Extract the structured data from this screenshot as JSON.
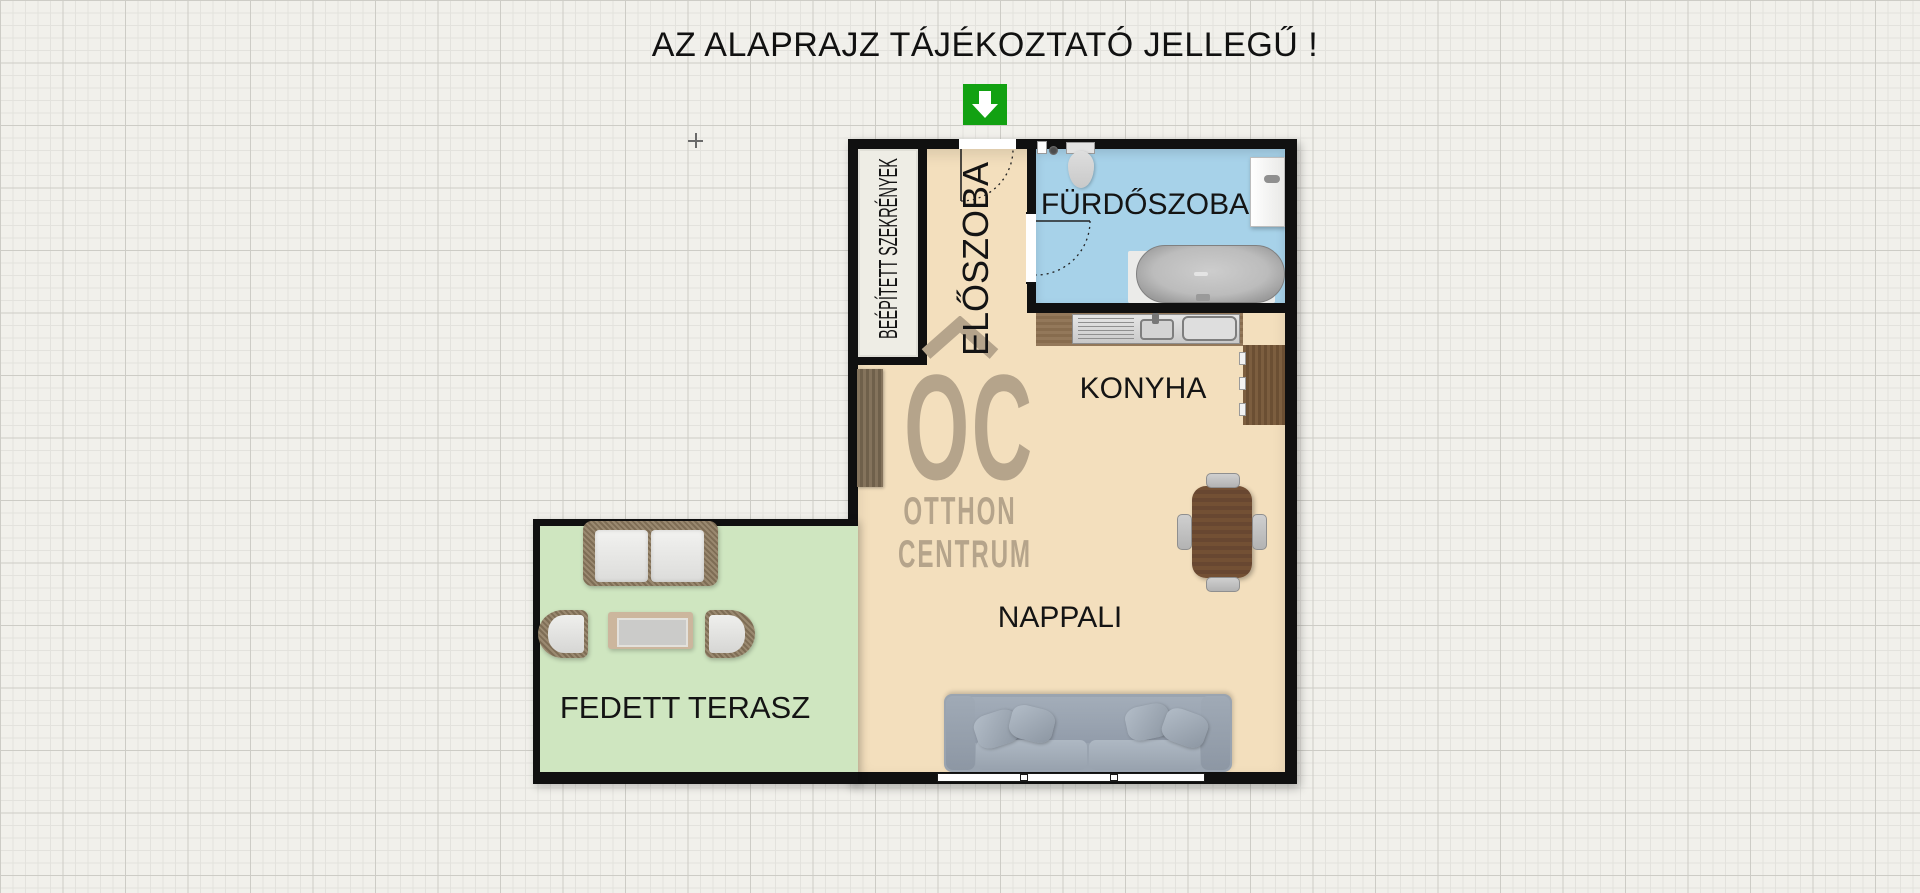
{
  "title": "AZ ALAPRAJZ TÁJÉKOZTATÓ JELLEGŰ !",
  "entrance": {
    "icon": "entrance-arrow-icon",
    "direction": "down",
    "color": "#12a112"
  },
  "rooms": {
    "hall": {
      "label": "ELŐSZOBA"
    },
    "closet": {
      "label": "BEÉPÍTETT SZEKRÉNYEK"
    },
    "bathroom": {
      "label": "FÜRDŐSZOBA"
    },
    "kitchen": {
      "label": "KONYHA"
    },
    "living": {
      "label": "NAPPALI"
    },
    "terrace": {
      "label": "FEDETT TERASZ"
    }
  },
  "watermark": {
    "roof_icon": "roof-chevron-icon",
    "initials": "OC",
    "line1": "OTTHON",
    "line2": "CENTRUM",
    "color": "#b5a48b"
  },
  "colors": {
    "background": "#f1f0eb",
    "grid_minor": "#e3e2dd",
    "grid_major": "#cdccc6",
    "wall": "#101010",
    "floor_main": "#f3dfbd",
    "floor_bathroom": "#a7d2e9",
    "floor_terrace": "#cfe6c0",
    "floor_closet": "#eeede5",
    "wood_counter": "#8d7356",
    "wood_cabinet": "#6b4f33",
    "sofa_gray": "#9aa4b0",
    "table_brown": "#6f4c31",
    "opening_white": "#ffffff"
  }
}
